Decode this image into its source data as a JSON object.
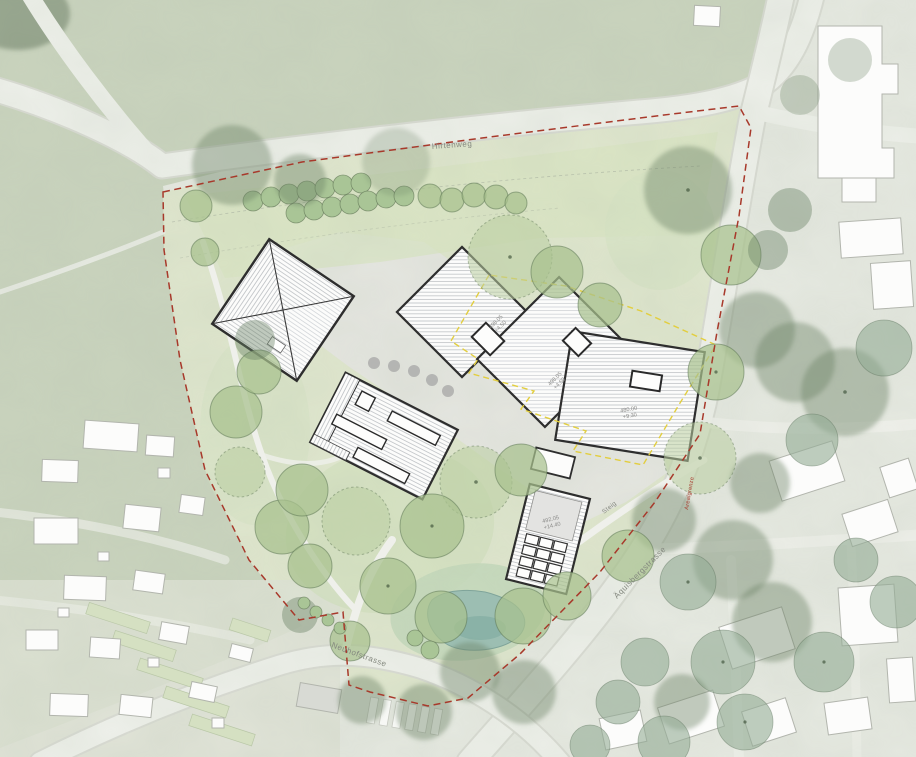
{
  "map": {
    "streets": {
      "hirtenweg": "Hirtenweg",
      "aquisbergstrasse": "Äquisbergstrasse",
      "neuhofstrasse": "Neuhofstrasse",
      "steig": "Steig"
    },
    "site_boundary": {
      "label": "Arealgrenze",
      "color": "#a8392b",
      "style": "dashed"
    },
    "setback_line_color": "#e2ce3f",
    "building_labels": {
      "northwest": {
        "elevation": "498.05",
        "height": "+4.50"
      },
      "central": {
        "elevation": "498.05",
        "height": "+4.50"
      },
      "east": {
        "elevation": "480.00",
        "height": "+9.30"
      },
      "south": {
        "elevation": "492.05",
        "height": "+14.40"
      }
    },
    "colors": {
      "field_green": "#c9d3bd",
      "site_lawn": "#d8e4c2",
      "tree_green": "#a7c18e",
      "road": "#eef0ea",
      "roof_white": "#fcfcfb",
      "roof_hatch": "#c3c6c9",
      "building_outline": "#2e2e2e",
      "pond": "#9cbeb2"
    }
  }
}
